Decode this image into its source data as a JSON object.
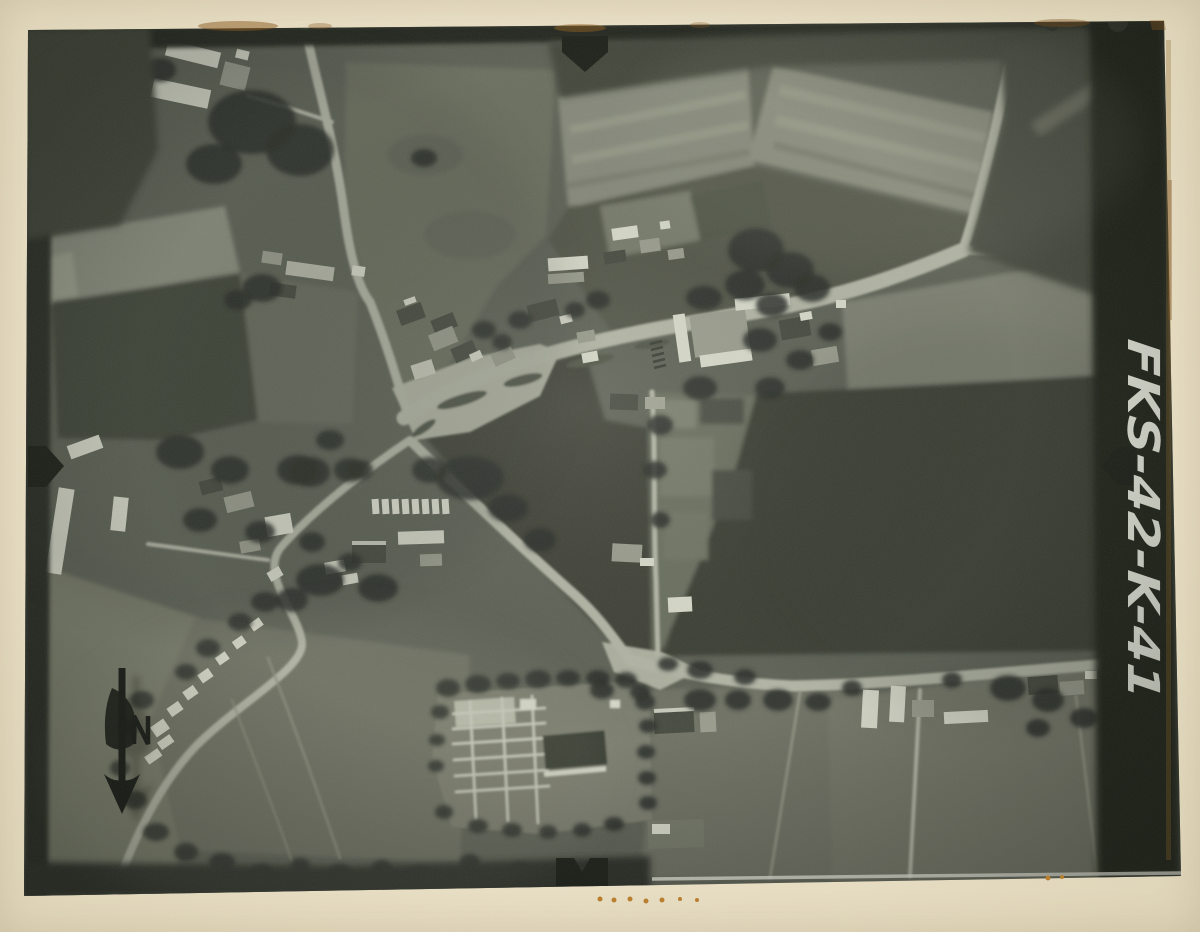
{
  "photo": {
    "handwritten_label": "FKS-42-K-41",
    "kind": "black-and-white vertical aerial photograph of a village crossroads with surrounding fields, mounted on cream card",
    "annotations": {
      "north_arrow": "hand-drawn arrow pointing down",
      "fiducial_marks": [
        "top-center",
        "bottom-center",
        "left-center",
        "right-center"
      ]
    }
  },
  "colors": {
    "mount": "#eae1c8",
    "photo_dark": "#23271e",
    "photo_base": "#5f6357",
    "field_dark": "#3d4136",
    "field_light": "#888b7d",
    "road": "#b3b6a6",
    "building_white": "#d8dacb",
    "tree": "#2c3028",
    "ink": "#1c1f19",
    "label": "#eceee2",
    "mark": "#1f231b",
    "stain": "#9a6524"
  }
}
